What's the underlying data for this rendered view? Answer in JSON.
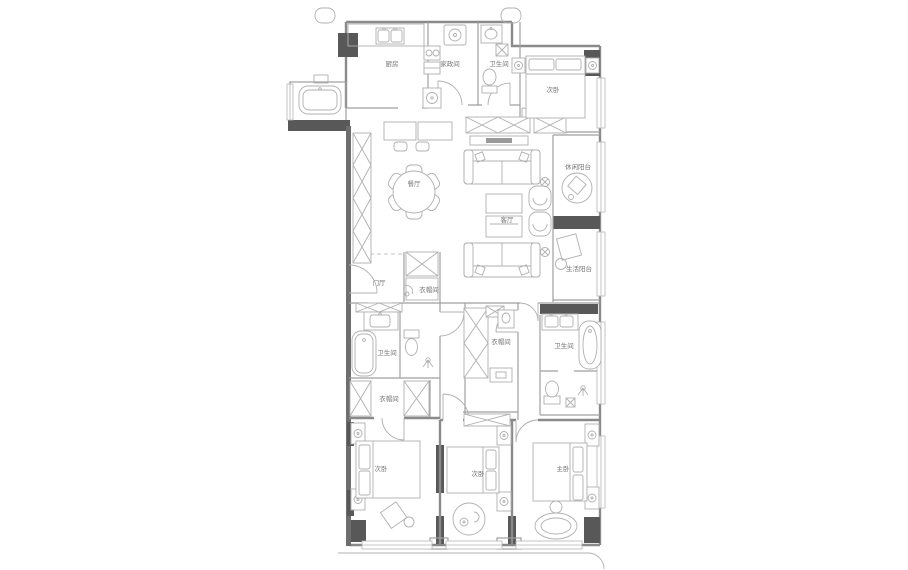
{
  "app": {
    "type": "apartment-floor-plan"
  },
  "colors": {
    "bg": "#ffffff",
    "wall": "#585858",
    "wall2": "#6e6e6e",
    "wallline": "#8a8a8a",
    "part": "#9f9f9f",
    "furn": "#b0b0b0",
    "winline": "#b5b5b5",
    "text": "#757575"
  },
  "rooms": {
    "kitchen": {
      "label": "厨房"
    },
    "laundry": {
      "label": "家政间"
    },
    "bath_top": {
      "label": "卫生间"
    },
    "bedroom_top": {
      "label": "次卧"
    },
    "dining": {
      "label": "餐厅"
    },
    "living": {
      "label": "客厅"
    },
    "balcony_top": {
      "label": "休闲阳台"
    },
    "balcony_bottom": {
      "label": "生活阳台"
    },
    "foyer": {
      "label": "门厅"
    },
    "foyer_closet": {
      "label": "衣帽间"
    },
    "bath_family": {
      "label": "卫生间"
    },
    "closet_left": {
      "label": "衣帽间"
    },
    "closet_master": {
      "label": "衣帽间"
    },
    "bath_master": {
      "label": "卫生间"
    },
    "bedroom_left": {
      "label": "次卧"
    },
    "bedroom_mid": {
      "label": "次卧"
    },
    "bedroom_master": {
      "label": "主卧"
    }
  }
}
